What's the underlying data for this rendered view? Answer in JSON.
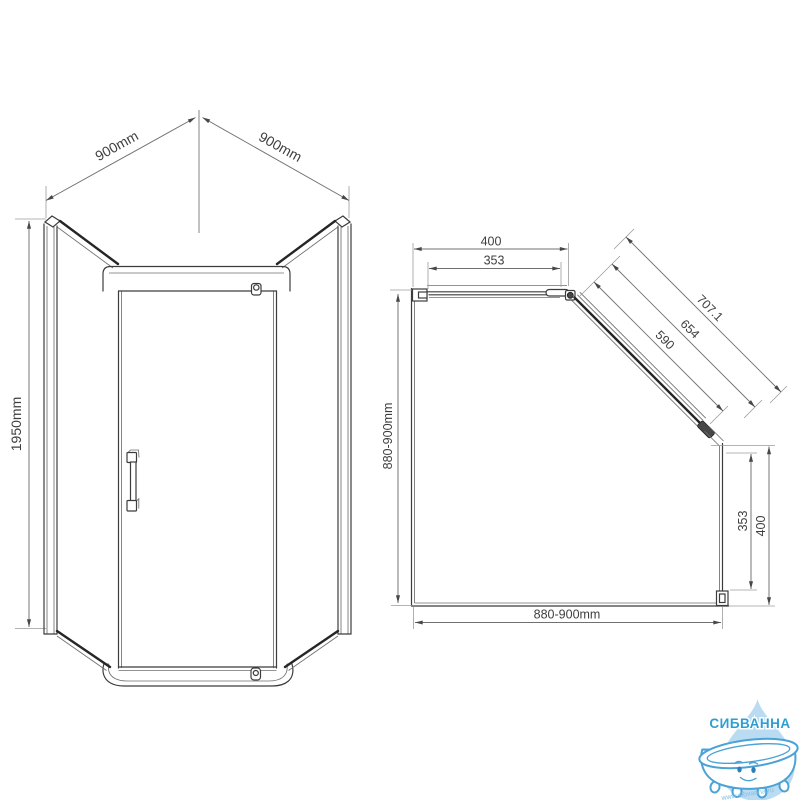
{
  "front_view": {
    "dim_top_left": "900mm",
    "dim_top_right": "900mm",
    "dim_height": "1950mm"
  },
  "plan_view": {
    "dim_top_total": "400",
    "dim_top_glass": "353",
    "dim_diagonal_total": "707.1",
    "dim_diagonal_mid": "654",
    "dim_diagonal_glass": "590",
    "dim_right_glass": "353",
    "dim_right_total": "400",
    "dim_left_depth": "880-900mm",
    "dim_bottom_width": "880-900mm"
  },
  "logo": {
    "brand": "СИБВАННА",
    "website": "www.sibvanna.ru",
    "colors": {
      "brand_text": "#2e9fd4",
      "drop_fill": "#badcf2",
      "tub_outline": "#4aa2d6"
    }
  }
}
